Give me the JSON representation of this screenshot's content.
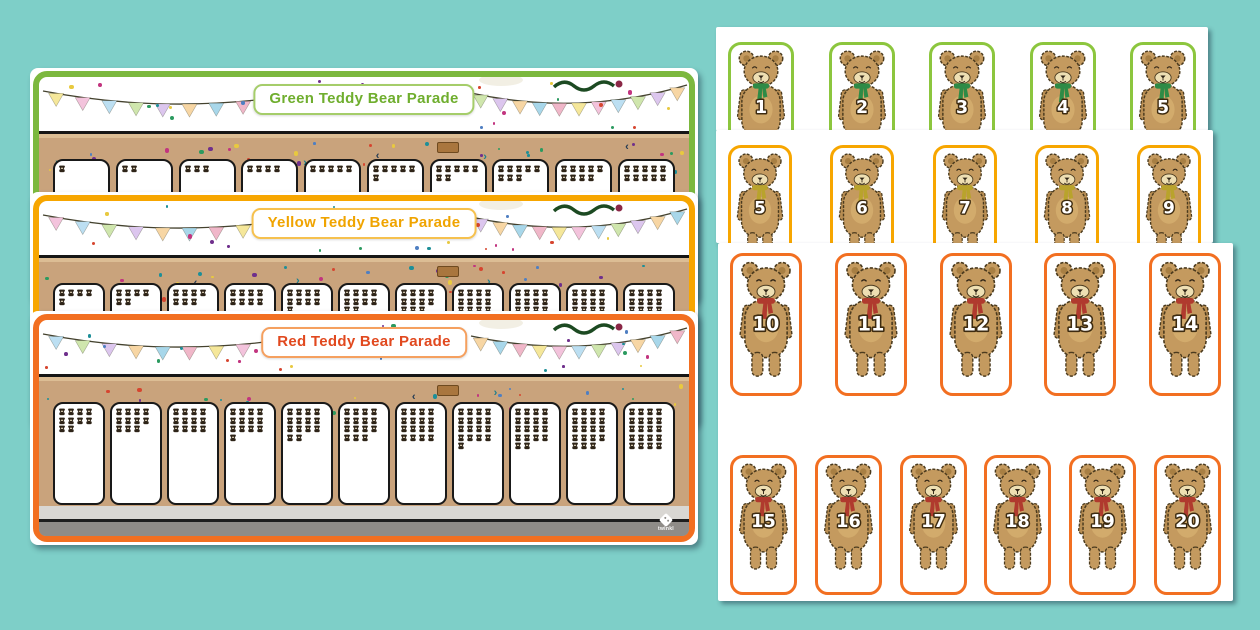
{
  "background_color": "#7ecfc8",
  "brand_logo": {
    "text": "twinkl"
  },
  "palette": {
    "bunting": [
      "#f5e79a",
      "#f3c3dc",
      "#bcdff2",
      "#cfe6ad",
      "#dcc6ee",
      "#f7d6a4",
      "#a8d7ea",
      "#f0b7c9"
    ],
    "confetti": [
      "#c2347f",
      "#6f2f8c",
      "#1d8f98",
      "#e8c93f",
      "#d6452f",
      "#4f7fc2",
      "#2b9a5f"
    ],
    "grass_dark": "#2e7c36",
    "grass_light": "#96c24c",
    "road": "#c9a37c",
    "chevron_teal": "#1d7f8c",
    "chevron_navy": "#233a52"
  },
  "mats": [
    {
      "title": "Green Teddy Bear Parade",
      "frame_color": "#7cb83e",
      "title_color": "#6fae2e",
      "banner_border": "#a5cd6a",
      "stand_width": 57,
      "stand_counts": [
        1,
        2,
        3,
        4,
        5,
        6,
        7,
        8,
        9,
        10
      ]
    },
    {
      "title": "Yellow Teddy Bear Parade",
      "frame_color": "#f7a600",
      "title_color": "#f0a400",
      "banner_border": "#f6c14e",
      "stand_width": 52,
      "stand_counts": [
        5,
        6,
        7,
        8,
        9,
        10,
        11,
        12,
        13,
        14,
        15
      ]
    },
    {
      "title": "Red Teddy Bear Parade",
      "frame_color": "#f26f21",
      "title_color": "#e1491f",
      "banner_border": "#f5a05f",
      "stand_width": 52,
      "stand_counts": [
        10,
        11,
        12,
        13,
        14,
        15,
        16,
        17,
        18,
        19,
        20
      ]
    }
  ],
  "card_pages": [
    {
      "card_border": "#8cc63e",
      "scarf_color": "#2e8b46",
      "rows": [
        [
          1,
          2,
          3,
          4,
          5
        ]
      ]
    },
    {
      "card_border": "#f7a600",
      "scarf_color": "#b9a32c",
      "rows": [
        [
          5,
          6,
          7,
          8,
          9
        ]
      ]
    },
    {
      "card_border": "#f26f21",
      "scarf_color": "#b03a2e",
      "rows": [
        [
          10,
          11,
          12,
          13,
          14
        ],
        [
          15,
          16,
          17,
          18,
          19,
          20
        ]
      ]
    }
  ]
}
